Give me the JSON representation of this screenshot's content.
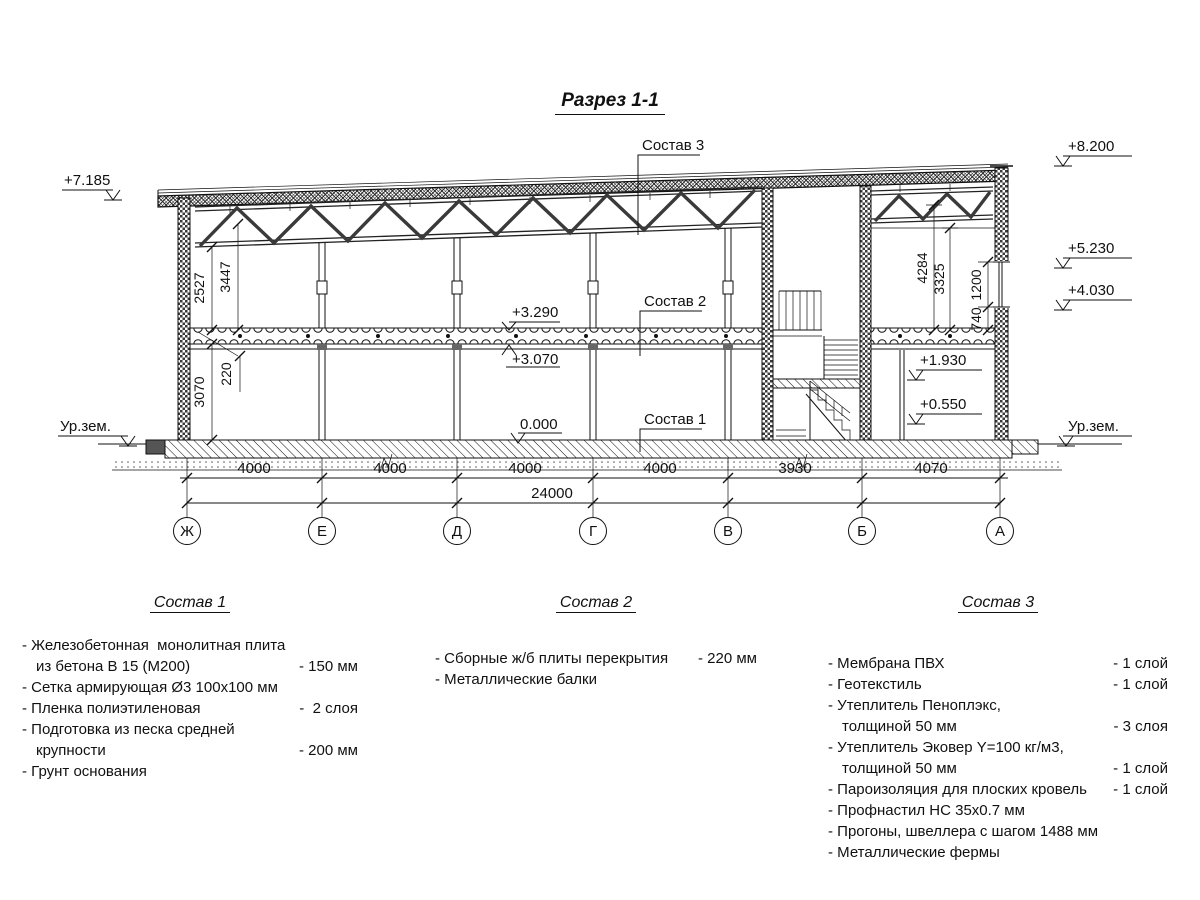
{
  "title": "Разрез 1-1",
  "callouts": {
    "c3": "Состав 3",
    "c2": "Состав 2",
    "c1": "Состав 1"
  },
  "elevations": {
    "left_roof": "+7.185",
    "top_right": "+8.200",
    "win_head": "+5.230",
    "win_sill": "+4.030",
    "slab_top": "+3.290",
    "slab_bot": "+3.070",
    "mezz": "+1.930",
    "porch": "+0.550",
    "zero": "0.000",
    "ground_left": "Ур.зем.",
    "ground_right": "Ур.зем."
  },
  "vdims": {
    "h2527": "2527",
    "h3447": "3447",
    "t220": "220",
    "h3070": "3070",
    "h4284": "4284",
    "h3325": "3325",
    "w740": "740",
    "w1200": "1200"
  },
  "chain": {
    "s0": "4000",
    "s1": "4000",
    "s2": "4000",
    "s3": "4000",
    "s4": "3930",
    "s5": "4070",
    "total": "24000"
  },
  "axes": [
    "Ж",
    "Е",
    "Д",
    "Г",
    "В",
    "Б",
    "А"
  ],
  "blocks": [
    {
      "heading": "Состав 1",
      "rows": [
        {
          "t": "- Железобетонная  монолитная плита",
          "v": ""
        },
        {
          "t": "из бетона В 15 (М200)",
          "v": "- 150 мм"
        },
        {
          "t": "- Сетка армирующая Ø3 100х100 мм",
          "v": ""
        },
        {
          "t": "- Пленка полиэтиленовая",
          "v": "-  2 слоя"
        },
        {
          "t": "- Подготовка из песка средней",
          "v": ""
        },
        {
          "t": "крупности",
          "v": "- 200 мм"
        },
        {
          "t": "- Грунт основания",
          "v": ""
        }
      ]
    },
    {
      "heading": "Состав 2",
      "rows": [
        {
          "t": "- Сборные ж/б плиты перекрытия",
          "v": "- 220 мм"
        },
        {
          "t": "- Металлические балки",
          "v": ""
        }
      ]
    },
    {
      "heading": "Состав 3",
      "rows": [
        {
          "t": "- Мембрана ПВХ",
          "v": "- 1 слой"
        },
        {
          "t": "- Геотекстиль",
          "v": "- 1 слой"
        },
        {
          "t": "- Утеплитель Пеноплэкс,",
          "v": ""
        },
        {
          "t": "толщиной 50 мм",
          "v": "- 3 слоя"
        },
        {
          "t": "- Утеплитель Эковер Y=100 кг/м3,",
          "v": ""
        },
        {
          "t": "толщиной 50 мм",
          "v": "- 1 слой"
        },
        {
          "t": "- Пароизоляция для плоских кровель",
          "v": "- 1 слой"
        },
        {
          "t": "- Профнастил НС 35х0.7 мм",
          "v": ""
        },
        {
          "t": "- Прогоны, швеллера с шагом 1488 мм",
          "v": ""
        },
        {
          "t": "- Металлические фермы",
          "v": ""
        }
      ]
    }
  ]
}
